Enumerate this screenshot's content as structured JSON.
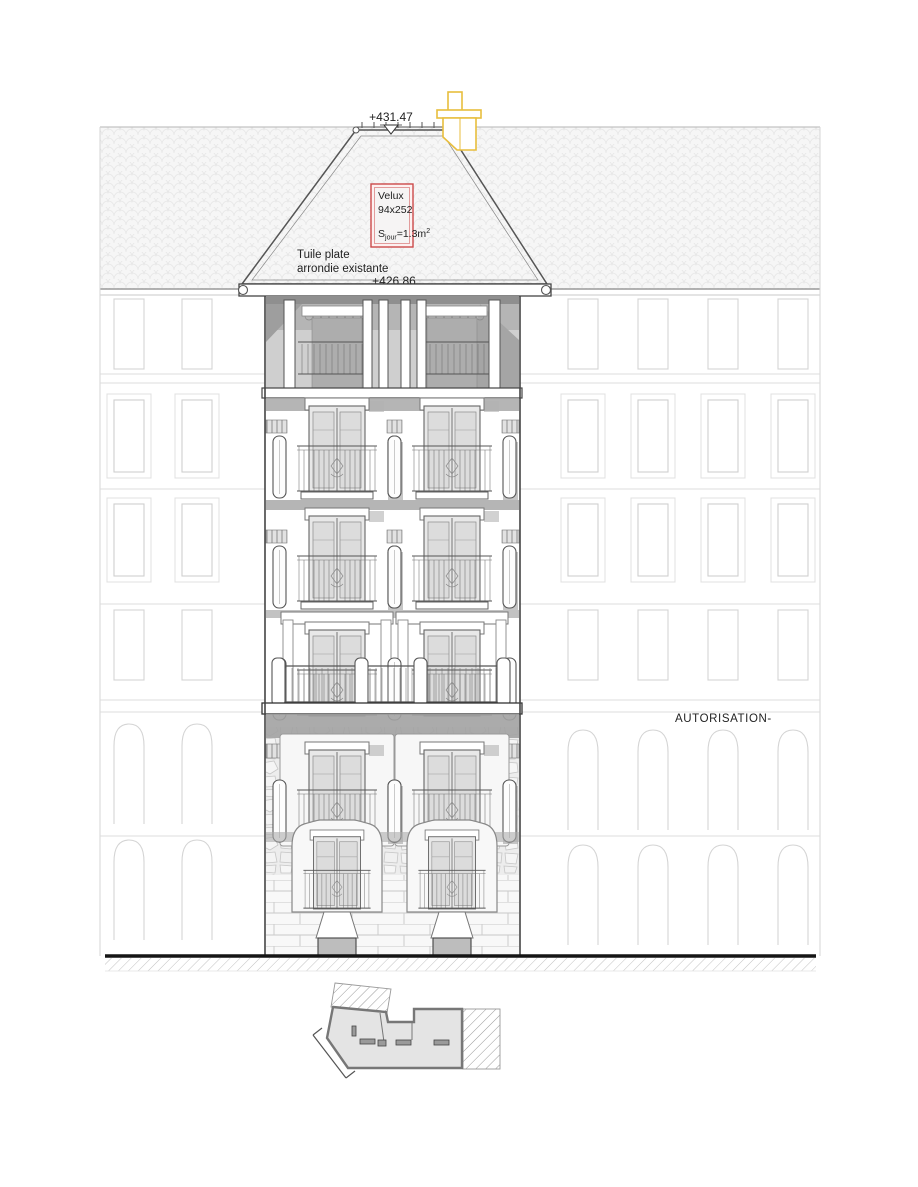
{
  "drawing": {
    "levels": {
      "ridge": "+431.47",
      "eaves": "+426.86"
    },
    "velux": {
      "name": "Velux",
      "size": "94x252",
      "area_prefix": "S",
      "area_sub": "jour",
      "area_mid": "=1.3m",
      "area_sup": "2"
    },
    "roof_note": {
      "line1": "Tuile plate",
      "line2": "arrondie existante"
    },
    "stamp": "AUTORISATION-",
    "colors": {
      "chimney_yellow": "#e8be3d",
      "velux_red": "#cc4a4a",
      "velux_fill": "#fdf0f0",
      "line_dark": "#444444",
      "line_faint": "#d8d8d8",
      "ground_black": "#151515",
      "plan_fill": "#e4e4e4",
      "shadow_gray": "#a8a8a8"
    }
  }
}
